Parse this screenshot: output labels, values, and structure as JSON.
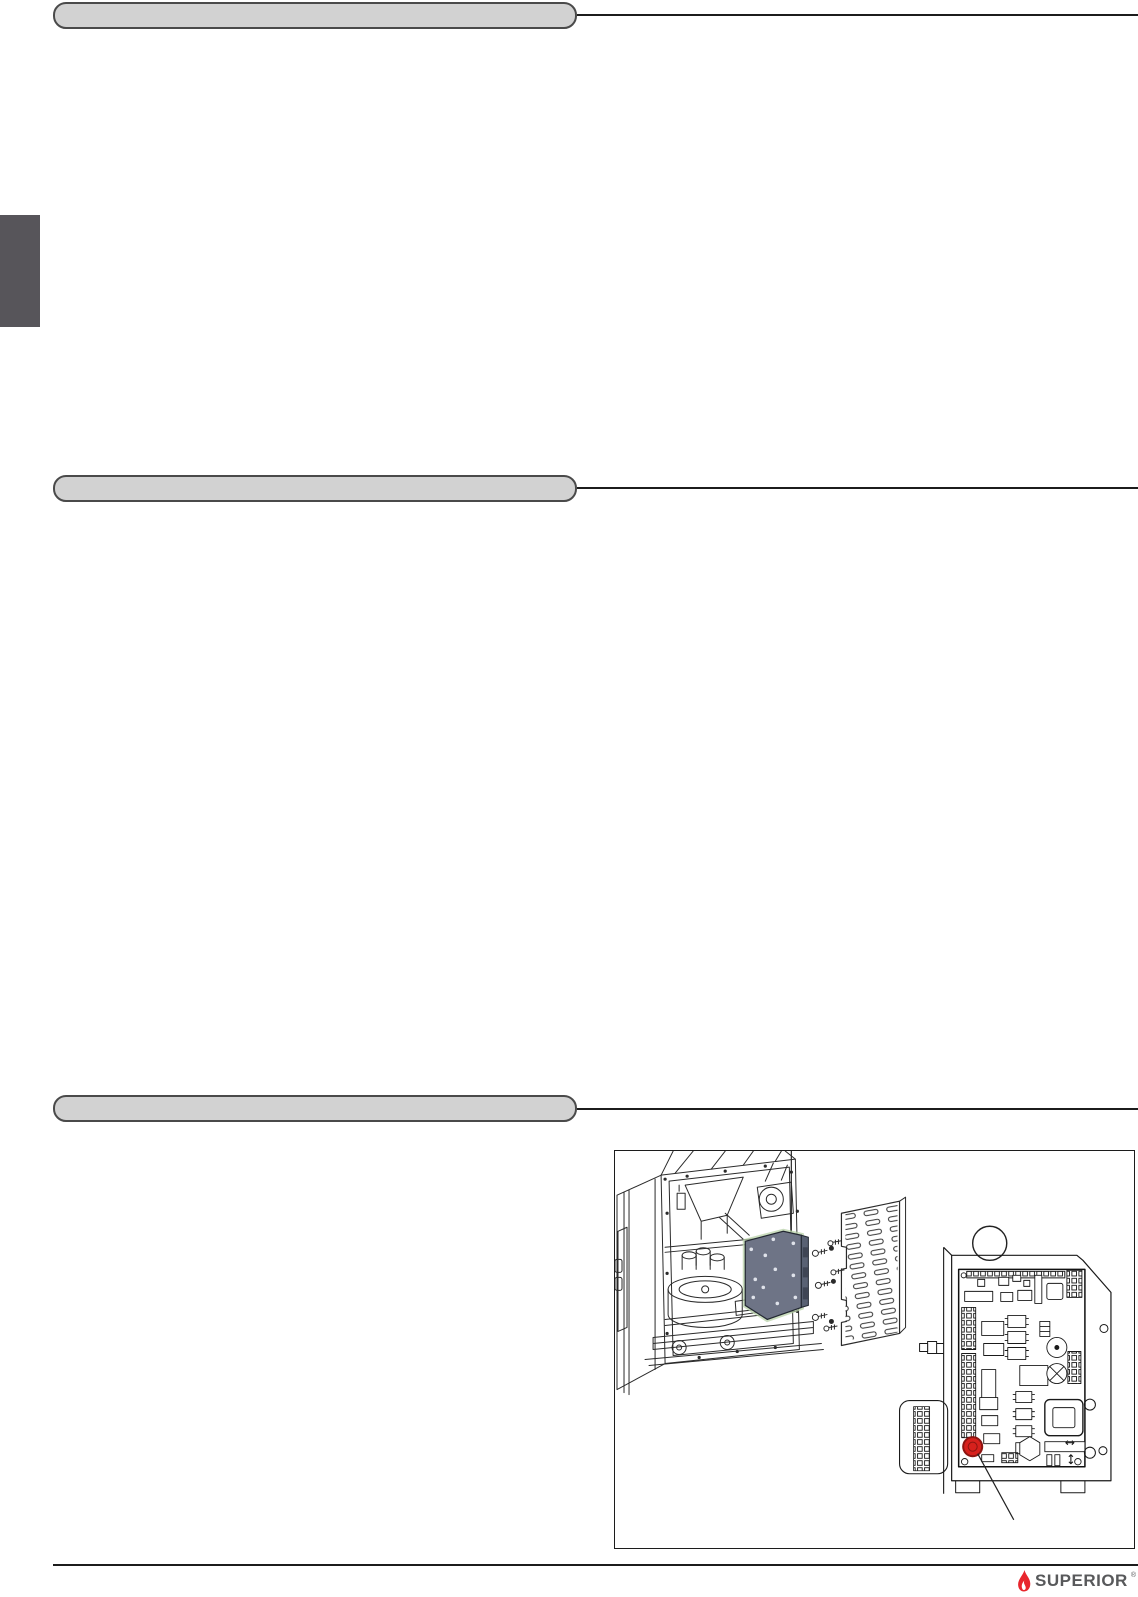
{
  "page": {
    "background": "#ffffff",
    "section_headers": [
      {
        "label": ""
      },
      {
        "label": ""
      },
      {
        "label": ""
      }
    ],
    "side_tab": {
      "color": "#57555a"
    }
  },
  "figure": {
    "callout_text": "",
    "colors": {
      "line_art": "#2b2b2b",
      "board_mounting_plate": "#6e7486",
      "plate_glow": "#b8d2a8",
      "reset_button_red": "#d7211d"
    }
  },
  "footer": {
    "brand": "SUPERIOR",
    "trademark_mark": "®",
    "flame_color": "#e8262d",
    "brand_color": "#58595b"
  }
}
